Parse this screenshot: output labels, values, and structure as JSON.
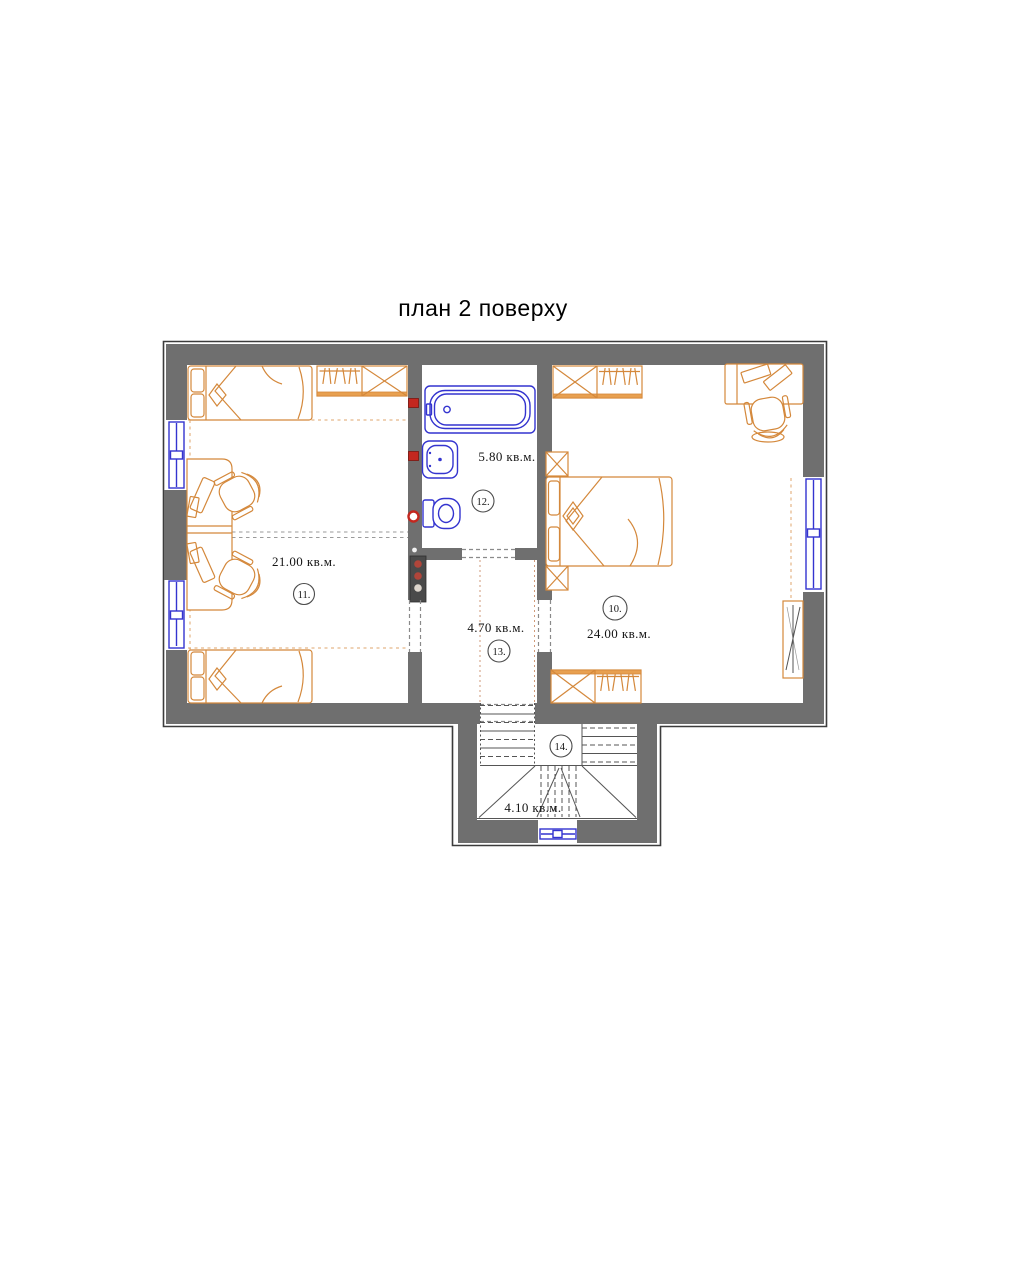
{
  "title": "план 2 поверху",
  "colors": {
    "wall": "#6f6f6f",
    "outline": "#3c3c3c",
    "furniture": "#d4883b",
    "furniture_fill": "#e8a050",
    "plumbing": "#3434cf",
    "valve": "#c3271f",
    "stairs": "#555555",
    "dashes": "#8a8a8a",
    "label": "#141414"
  },
  "rooms": [
    {
      "number": "10.",
      "area": "24.00 кв.м."
    },
    {
      "number": "11.",
      "area": "21.00 кв.м."
    },
    {
      "number": "12.",
      "area": "5.80 кв.м."
    },
    {
      "number": "13.",
      "area": "4.70 кв.м."
    },
    {
      "number": "14.",
      "area": "4.10 кв.м."
    }
  ]
}
